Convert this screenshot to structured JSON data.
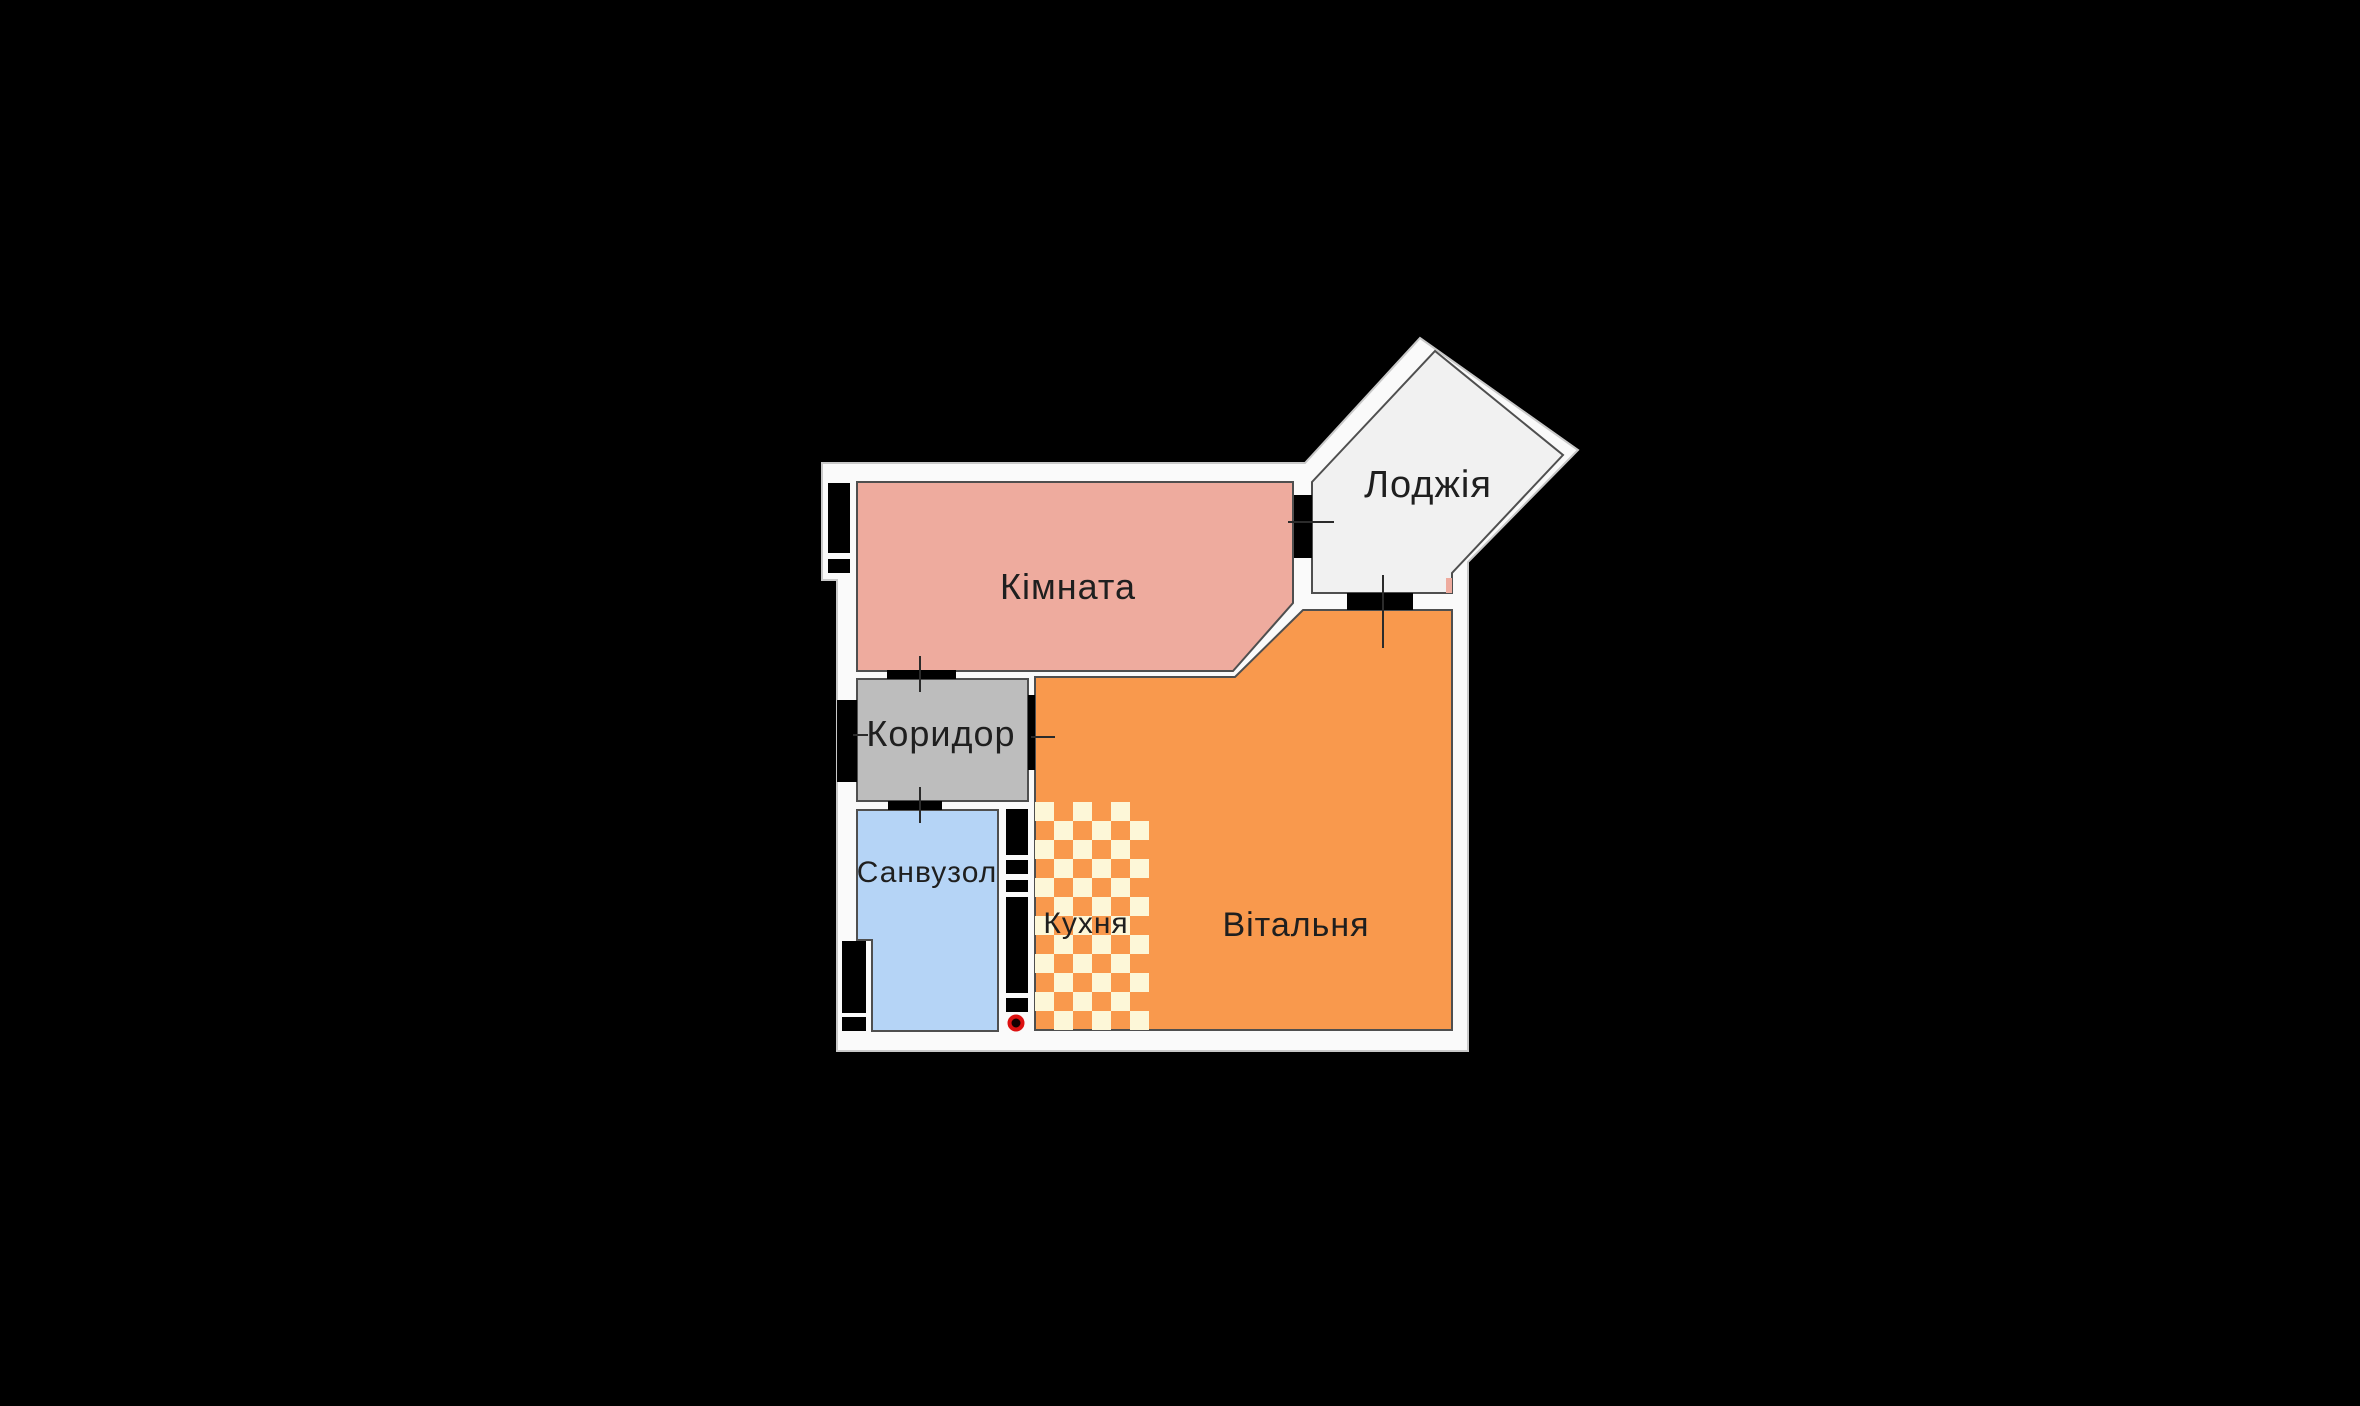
{
  "title": "apartment-floor-plan",
  "background": "#000000",
  "colors": {
    "walls": "#fafafa",
    "wall_outline": "#c9c9c9",
    "room_outline": "#4f4f4f",
    "kimnata": "#eeab9e",
    "loggia": "#f1f1f1",
    "korydor": "#bdbdbd",
    "sanvuzol": "#b5d4f6",
    "vitalnia": "#f9994d",
    "kitchen_cream": "#fdf7d8",
    "feature_black": "#000000",
    "tick": "#2b2b2b",
    "label": "#1f1f1f",
    "marker_fill": "#140000",
    "marker_stroke": "#dd1111"
  },
  "rooms": {
    "kimnata": {
      "label": "Кімната"
    },
    "loggia": {
      "label": "Лоджія"
    },
    "korydor": {
      "label": "Коридор"
    },
    "sanvuzol": {
      "label": "Санвузол"
    },
    "kukhnia": {
      "label": "Кухня"
    },
    "vitalnia": {
      "label": "Вітальня"
    }
  }
}
